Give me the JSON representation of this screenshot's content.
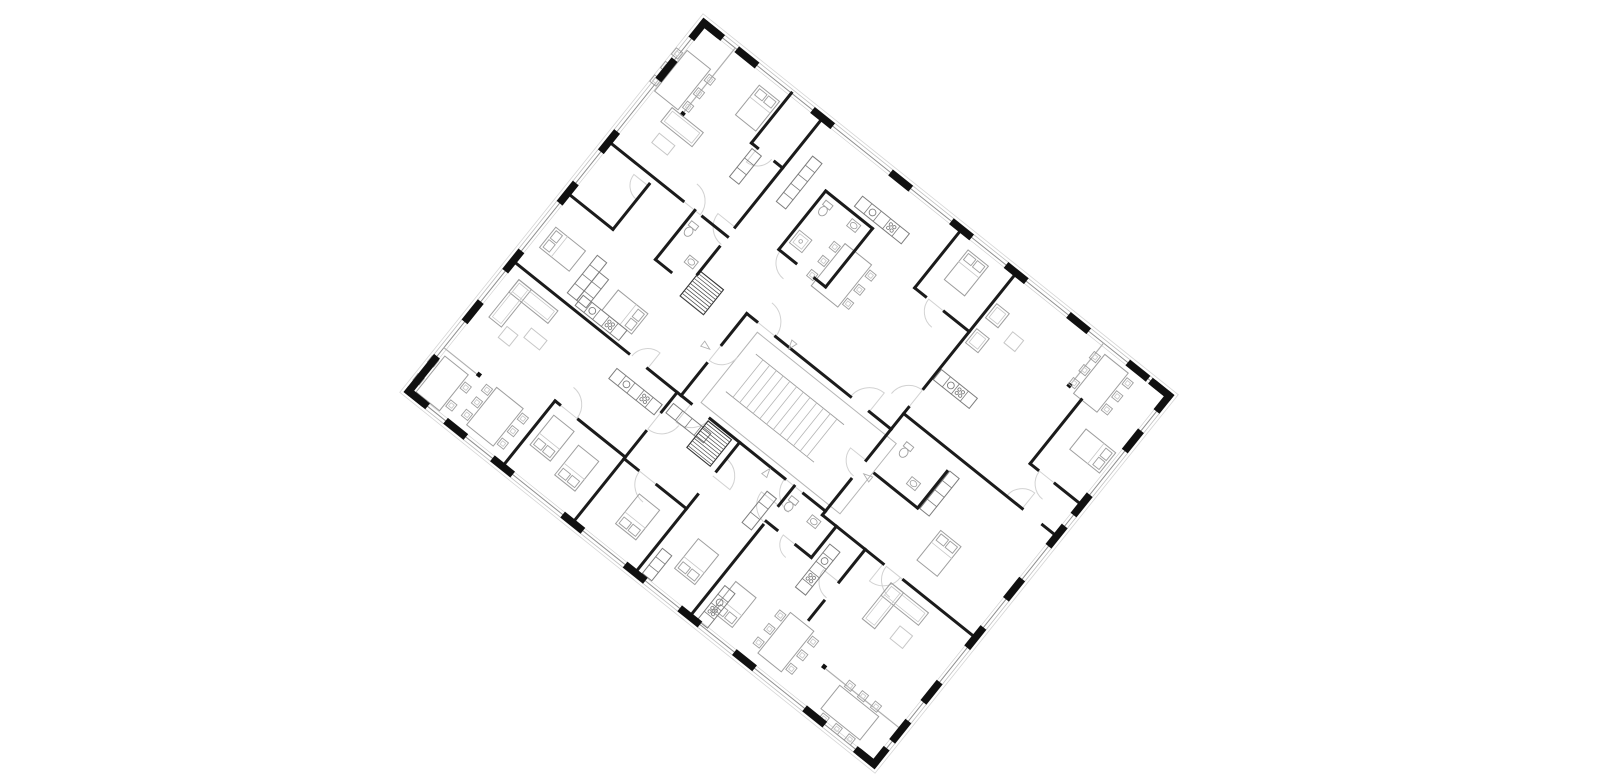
{
  "meta": {
    "canvas_w": 1600,
    "canvas_h": 775,
    "background": "#ffffff"
  },
  "plan": {
    "origin": {
      "x": 704,
      "y": 23
    },
    "rotation_deg": 38.7,
    "width": 596,
    "height": 472,
    "colors": {
      "wall": "#1b1b1b",
      "pier": "#101010",
      "furn": "#9e9e9e",
      "furn_light": "#c7c7c7",
      "furn_dark": "#7d7d7d",
      "glaze": "#b0b0b0",
      "outline1": "#8f8f8f",
      "outline2": "#c0c0c0",
      "outline3": "#d6d6d6",
      "inner_line": "#cdcdcd",
      "arc": "#d2d2d2",
      "corridor": "#b5b5b5",
      "hatch": "#4a4a4a",
      "tri": "#b0b0b0"
    },
    "facade": {
      "outline_offsets": [
        0,
        3.5,
        6.5
      ],
      "inner_inset": 3,
      "pier_len": 26,
      "pier_th": 7.5,
      "corner_len": 24,
      "piers": {
        "top": [
          55,
          152,
          252,
          330,
          400,
          480,
          556
        ],
        "right": [
          58,
          140,
          180,
          248,
          310,
          380,
          430
        ],
        "bottom": [
          60,
          120,
          210,
          290,
          360,
          430,
          520
        ],
        "left": [
          60,
          152,
          218,
          305,
          370,
          440
        ]
      }
    },
    "walls": [
      [
        215,
        200,
        228,
        200
      ],
      [
        252,
        200,
        348,
        200
      ],
      [
        372,
        200,
        400,
        200
      ],
      [
        215,
        305,
        228,
        305
      ],
      [
        252,
        305,
        348,
        305
      ],
      [
        372,
        305,
        400,
        305
      ],
      [
        215,
        200,
        215,
        240
      ],
      [
        215,
        264,
        215,
        305
      ],
      [
        400,
        200,
        400,
        240
      ],
      [
        400,
        264,
        400,
        305
      ],
      [
        152,
        0,
        152,
        140
      ],
      [
        152,
        165,
        152,
        200
      ],
      [
        0,
        152,
        95,
        152
      ],
      [
        120,
        152,
        152,
        152
      ],
      [
        400,
        0,
        400,
        148
      ],
      [
        400,
        172,
        400,
        200
      ],
      [
        400,
        180,
        552,
        180
      ],
      [
        578,
        180,
        596,
        180
      ],
      [
        400,
        310,
        478,
        310
      ],
      [
        504,
        310,
        596,
        310
      ],
      [
        0,
        305,
        148,
        305
      ],
      [
        172,
        305,
        215,
        305
      ],
      [
        210,
        305,
        210,
        330
      ],
      [
        210,
        355,
        210,
        472
      ],
      [
        360,
        305,
        360,
        330
      ],
      [
        360,
        355,
        360,
        472
      ],
      [
        455,
        310,
        455,
        352
      ],
      [
        455,
        376,
        455,
        400
      ],
      [
        112,
        0,
        112,
        64
      ],
      [
        112,
        64,
        120,
        64
      ],
      [
        142,
        64,
        152,
        64
      ],
      [
        0,
        218,
        58,
        218
      ],
      [
        58,
        160,
        58,
        218
      ],
      [
        110,
        152,
        110,
        215
      ],
      [
        110,
        215,
        130,
        215
      ],
      [
        200,
        55,
        200,
        130
      ],
      [
        200,
        55,
        260,
        55
      ],
      [
        260,
        55,
        260,
        130
      ],
      [
        200,
        130,
        222,
        130
      ],
      [
        246,
        130,
        260,
        130
      ],
      [
        330,
        0,
        330,
        75
      ],
      [
        330,
        75,
        344,
        75
      ],
      [
        368,
        75,
        400,
        75
      ],
      [
        530,
        58,
        530,
        140
      ],
      [
        530,
        140,
        540,
        140
      ],
      [
        562,
        140,
        596,
        140
      ],
      [
        415,
        245,
        470,
        245
      ],
      [
        470,
        198,
        470,
        245
      ],
      [
        290,
        305,
        290,
        342
      ],
      [
        290,
        372,
        290,
        472
      ],
      [
        210,
        390,
        228,
        390
      ],
      [
        252,
        390,
        290,
        390
      ],
      [
        120,
        388,
        126,
        388
      ],
      [
        150,
        388,
        210,
        388
      ],
      [
        120,
        388,
        120,
        472
      ],
      [
        400,
        305,
        400,
        310
      ],
      [
        418,
        310,
        418,
        350
      ],
      [
        360,
        350,
        374,
        350
      ],
      [
        398,
        350,
        418,
        350
      ]
    ],
    "dividers": [
      {
        "line": [
          40,
          0,
          40,
          86
        ],
        "post": [
          38,
          82
        ]
      },
      {
        "line": [
          0,
          416,
          46,
          416
        ],
        "post": [
          42,
          413
        ]
      },
      {
        "line": [
          512,
          0,
          512,
          56
        ],
        "post": [
          509.5,
          52
        ]
      },
      {
        "line": [
          496,
          428,
          596,
          428
        ],
        "post": [
          494,
          425
        ]
      }
    ],
    "corridor": {
      "x": 235,
      "y": 208,
      "w": 178,
      "h": 90
    },
    "stair": {
      "x": 248,
      "y": 226,
      "w": 112,
      "h": 48,
      "treads": 13
    },
    "hatches": [
      {
        "x": 252,
        "y": 308,
        "w": 30,
        "h": 34
      },
      {
        "x": 152,
        "y": 196,
        "w": 30,
        "h": 32
      }
    ],
    "furniture": [
      {
        "t": "bed",
        "x": 82,
        "y": 14,
        "w": 26,
        "h": 38,
        "head": "n"
      },
      {
        "t": "bed",
        "x": 348,
        "y": 12,
        "w": 26,
        "h": 38,
        "head": "n"
      },
      {
        "t": "bed",
        "x": 12,
        "y": 252,
        "w": 38,
        "h": 26,
        "head": "w"
      },
      {
        "t": "bed",
        "x": 100,
        "y": 262,
        "w": 38,
        "h": 26,
        "head": "e"
      },
      {
        "t": "bed",
        "x": 552,
        "y": 78,
        "w": 38,
        "h": 26,
        "head": "e"
      },
      {
        "t": "bed",
        "x": 502,
        "y": 248,
        "w": 26,
        "h": 38,
        "head": "n"
      },
      {
        "t": "bed",
        "x": 128,
        "y": 400,
        "w": 26,
        "h": 38,
        "head": "s"
      },
      {
        "t": "bed",
        "x": 166,
        "y": 408,
        "w": 26,
        "h": 38,
        "head": "s"
      },
      {
        "t": "bed",
        "x": 244,
        "y": 408,
        "w": 26,
        "h": 38,
        "head": "s"
      },
      {
        "t": "bed",
        "x": 318,
        "y": 406,
        "w": 26,
        "h": 38,
        "head": "s"
      },
      {
        "t": "bed",
        "x": 374,
        "y": 416,
        "w": 26,
        "h": 38,
        "head": "s"
      },
      {
        "t": "table",
        "x": 4,
        "y": 32,
        "w": 30,
        "h": 52,
        "cps": 3,
        "sides": "ew"
      },
      {
        "t": "table",
        "x": 248,
        "y": 84,
        "w": 34,
        "h": 54,
        "cps": 3,
        "sides": "ew"
      },
      {
        "t": "table",
        "x": 520,
        "y": 8,
        "w": 30,
        "h": 50,
        "cps": 3,
        "sides": "ew"
      },
      {
        "t": "table",
        "x": 6,
        "y": 422,
        "w": 30,
        "h": 46,
        "cps": 2,
        "sides": "ew"
      },
      {
        "t": "table",
        "x": 66,
        "y": 414,
        "w": 34,
        "h": 48,
        "cps": 3,
        "sides": "ew"
      },
      {
        "t": "table",
        "x": 436,
        "y": 406,
        "w": 30,
        "h": 52,
        "cps": 3,
        "sides": "ew"
      },
      {
        "t": "table",
        "x": 520,
        "y": 432,
        "w": 50,
        "h": 30,
        "cps": 3,
        "sides": "ns"
      },
      {
        "t": "sofa",
        "x": 28,
        "y": 86,
        "w": 40,
        "h": 18
      },
      {
        "t": "coffee",
        "x": 34,
        "y": 114,
        "w": 20,
        "h": 12
      },
      {
        "t": "chair",
        "x": 404,
        "y": 36,
        "w": 16,
        "h": 18
      },
      {
        "t": "chair",
        "x": 404,
        "y": 68,
        "w": 16,
        "h": 18
      },
      {
        "t": "coffee",
        "x": 434,
        "y": 48,
        "w": 14,
        "h": 14
      },
      {
        "t": "sofaL",
        "x": 16,
        "y": 316,
        "a": [
          50,
          16
        ],
        "b": [
          16,
          48
        ]
      },
      {
        "t": "coffee",
        "x": 56,
        "y": 346,
        "w": 20,
        "h": 12
      },
      {
        "t": "coffee",
        "x": 36,
        "y": 360,
        "w": 14,
        "h": 14
      },
      {
        "t": "sofaL",
        "x": 496,
        "y": 320,
        "a": [
          48,
          16
        ],
        "b": [
          16,
          46
        ]
      },
      {
        "t": "coffee",
        "x": 530,
        "y": 348,
        "w": 16,
        "h": 16
      },
      {
        "t": "chair",
        "x": 1020,
        "y": 0,
        "w": 0,
        "h": 0,
        "skip": true
      },
      {
        "t": "kitchen",
        "x": 232,
        "y": 36,
        "w": 60,
        "h": 13,
        "dir": "h"
      },
      {
        "t": "kitchen",
        "x": 76,
        "y": 288,
        "w": 56,
        "h": 13,
        "dir": "h"
      },
      {
        "t": "kitchen",
        "x": 402,
        "y": 122,
        "w": 46,
        "h": 13,
        "dir": "h"
      },
      {
        "t": "kitchen",
        "x": 148,
        "y": 324,
        "w": 58,
        "h": 13,
        "dir": "h"
      },
      {
        "t": "kitchen",
        "x": 424,
        "y": 328,
        "w": 13,
        "h": 55,
        "dir": "v"
      },
      {
        "t": "kitchen",
        "x": 368,
        "y": 426,
        "w": 13,
        "h": 44,
        "dir": "v"
      },
      {
        "t": "wardrobe",
        "x": 168,
        "y": 36,
        "w": 12,
        "h": 58,
        "dir": "v"
      },
      {
        "t": "wardrobe",
        "x": 62,
        "y": 248,
        "w": 12,
        "h": 48,
        "dir": "v"
      },
      {
        "t": "wardrobe",
        "x": 74,
        "y": 260,
        "w": 12,
        "h": 36,
        "dir": "v"
      },
      {
        "t": "wardrobe",
        "x": 472,
        "y": 196,
        "w": 12,
        "h": 48,
        "dir": "v"
      },
      {
        "t": "wardrobe",
        "x": 214,
        "y": 316,
        "w": 48,
        "h": 12,
        "dir": "h"
      },
      {
        "t": "wardrobe",
        "x": 342,
        "y": 326,
        "w": 12,
        "h": 40,
        "dir": "v"
      },
      {
        "t": "wardrobe",
        "x": 296,
        "y": 436,
        "w": 12,
        "h": 32,
        "dir": "v"
      },
      {
        "t": "wardrobe",
        "x": 116,
        "y": 68,
        "w": 12,
        "h": 36,
        "dir": "v"
      },
      {
        "t": "wc",
        "x": 206,
        "y": 62
      },
      {
        "t": "sink",
        "x": 238,
        "y": 60
      },
      {
        "t": "shower",
        "x": 204,
        "y": 102
      },
      {
        "t": "wc",
        "x": 114,
        "y": 162
      },
      {
        "t": "sink",
        "x": 134,
        "y": 190
      },
      {
        "t": "wc",
        "x": 420,
        "y": 200
      },
      {
        "t": "sink",
        "x": 446,
        "y": 224
      },
      {
        "t": "wc",
        "x": 364,
        "y": 314
      },
      {
        "t": "sink",
        "x": 392,
        "y": 316
      }
    ],
    "arcs": [
      [
        228,
        200,
        24,
        270,
        360
      ],
      [
        372,
        200,
        24,
        180,
        270
      ],
      [
        228,
        305,
        24,
        0,
        90
      ],
      [
        372,
        305,
        24,
        90,
        180
      ],
      [
        215,
        240,
        20,
        0,
        90
      ],
      [
        400,
        240,
        20,
        90,
        180
      ],
      [
        152,
        140,
        22,
        90,
        180
      ],
      [
        95,
        152,
        22,
        270,
        360
      ],
      [
        400,
        172,
        22,
        180,
        270
      ],
      [
        222,
        130,
        20,
        90,
        180
      ],
      [
        562,
        140,
        20,
        90,
        180
      ],
      [
        478,
        310,
        22,
        0,
        90
      ],
      [
        210,
        330,
        22,
        0,
        90
      ],
      [
        360,
        330,
        22,
        90,
        180
      ],
      [
        126,
        388,
        22,
        270,
        360
      ],
      [
        252,
        390,
        22,
        90,
        180
      ],
      [
        290,
        348,
        22,
        270,
        360
      ],
      [
        455,
        352,
        20,
        90,
        180
      ],
      [
        58,
        162,
        18,
        90,
        180
      ],
      [
        368,
        75,
        20,
        90,
        180
      ],
      [
        120,
        64,
        18,
        0,
        90
      ],
      [
        504,
        310,
        22,
        90,
        180
      ],
      [
        172,
        305,
        20,
        180,
        270
      ],
      [
        552,
        180,
        20,
        180,
        270
      ],
      [
        398,
        350,
        16,
        90,
        180
      ]
    ],
    "triangles": [
      [
        203,
        251,
        0
      ],
      [
        412,
        252,
        180
      ],
      [
        330,
        312,
        270
      ],
      [
        270,
        196,
        90
      ]
    ]
  }
}
